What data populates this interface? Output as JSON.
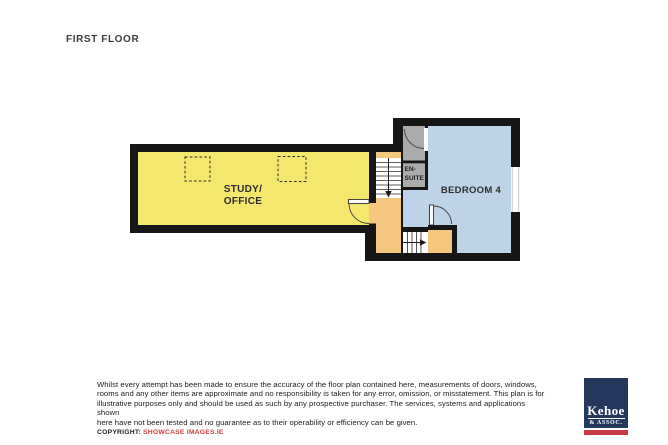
{
  "title": "FIRST FLOOR",
  "plan": {
    "colors": {
      "wall": "#161616",
      "landing": "#f5c77e",
      "stair_floor": "#ffffff",
      "window_frame": "#c7c7c7"
    },
    "rooms": {
      "study": {
        "label_line1": "STUDY/",
        "label_line2": "OFFICE",
        "color": "#f4e76d"
      },
      "bedroom": {
        "label": "BEDROOM 4",
        "color": "#bdd3e7"
      },
      "ensuite": {
        "label_line1": "EN-",
        "label_line2": "SUITE",
        "color": "#ababab"
      }
    },
    "stairs": {
      "upper_direction": "down",
      "lower_direction": "right"
    },
    "features": [
      "two dashed roof-light squares in study",
      "window on bedroom right wall",
      "three door swing arcs"
    ]
  },
  "disclaimer": {
    "lines": [
      "Whilst every attempt has been made to ensure the accuracy of the floor plan contained here, measurements of doors, windows,",
      "rooms and any other items are approximate and no responsibility is taken for any error, omission, or misstatement.  This plan is for",
      "illustrative purposes only and should be used as such by any prospective purchaser.  The services, systems and applications shown",
      "here have not been tested and no guarantee as to their operability or efficiency can be given."
    ]
  },
  "copyright": {
    "label": "COPYRIGHT: ",
    "value": "SHOWCASE IMAGES.IE",
    "value_color": "#d93b40"
  },
  "logo": {
    "name": "Kehoe",
    "subtitle": "& ASSOC.",
    "box_color": "#24385c",
    "stripe_color": "#c93a47"
  }
}
